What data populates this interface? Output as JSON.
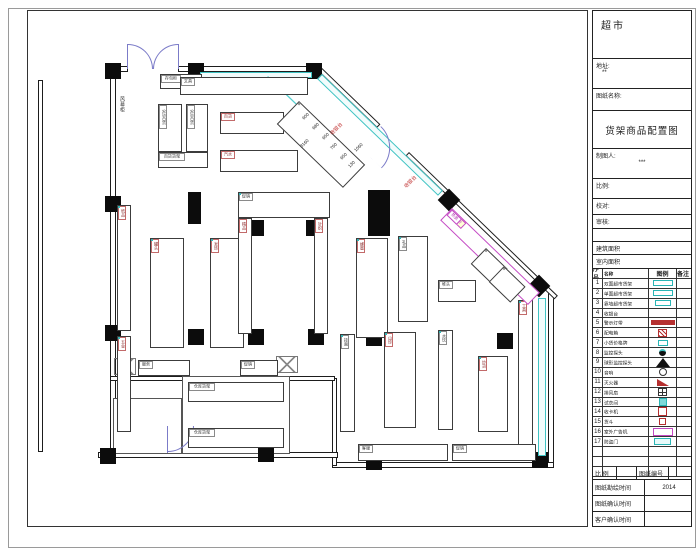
{
  "title_block": {
    "store_name": "超市",
    "address_label": "地址:",
    "address_value": "**",
    "drawing_name_label": "图纸名称:",
    "drawing_title": "货架商品配置图",
    "drafter_label": "制图人:",
    "drafter_value": "***",
    "scale_label": "比例:",
    "check_label": "校对:",
    "review_label": "审核:",
    "building_area_label": "建筑面积",
    "interior_area_label": "室内面积",
    "legend_header": {
      "no": "序号",
      "name": "名称",
      "symbol": "图例",
      "note": "备注"
    },
    "legend_rows": [
      {
        "no": "1",
        "name": "双面超市货架",
        "sym": "cyan-rect"
      },
      {
        "no": "2",
        "name": "单面超市货架",
        "sym": "cyan-rect"
      },
      {
        "no": "3",
        "name": "靠墙超市货架",
        "sym": "cyan-rect-sm"
      },
      {
        "no": "4",
        "name": "收银台",
        "sym": "m-text"
      },
      {
        "no": "5",
        "name": "警示灯带",
        "sym": "red-bar"
      },
      {
        "no": "6",
        "name": "配电箱",
        "sym": "red-hatch"
      },
      {
        "no": "7",
        "name": "小货价格牌",
        "sym": "cyan-sm"
      },
      {
        "no": "8",
        "name": "监控探头",
        "sym": "dot-arc"
      },
      {
        "no": "9",
        "name": "球形监控探头",
        "sym": "fan"
      },
      {
        "no": "10",
        "name": "音响",
        "sym": "circle"
      },
      {
        "no": "11",
        "name": "灭火器",
        "sym": "red-flag"
      },
      {
        "no": "12",
        "name": "排风扇",
        "sym": "grid-sq"
      },
      {
        "no": "13",
        "name": "试衣间",
        "sym": "cyan-fill"
      },
      {
        "no": "14",
        "name": "收卡机",
        "sym": "red-outline"
      },
      {
        "no": "15",
        "name": "货斗",
        "sym": "red-outline-sm"
      },
      {
        "no": "16",
        "name": "室外广告机",
        "sym": "magenta-rect"
      },
      {
        "no": "17",
        "name": "防盗门",
        "sym": "cyan-label"
      },
      {
        "no": "",
        "name": "",
        "sym": "none"
      },
      {
        "no": "",
        "name": "",
        "sym": "none"
      },
      {
        "no": "",
        "name": "",
        "sym": "none"
      }
    ],
    "bottom_rows": {
      "scale_label": "比 例",
      "scale_value": "",
      "number_label": "图纸编号",
      "number_value": "",
      "survey_label": "图纸勘绘时间",
      "survey_value": "2014",
      "confirm_label": "图纸确认时间",
      "confirm_value": "",
      "client_label": "客户确认时间",
      "client_value": ""
    }
  },
  "plan": {
    "walls": [
      [
        38,
        80,
        5,
        372
      ],
      [
        110,
        64,
        6,
        392
      ],
      [
        110,
        66,
        18,
        6
      ],
      [
        178,
        66,
        142,
        6
      ],
      [
        548,
        292,
        6,
        176
      ],
      [
        332,
        462,
        222,
        6
      ],
      [
        332,
        378,
        5,
        88
      ],
      [
        110,
        376,
        225,
        5
      ],
      [
        98,
        452,
        240,
        6
      ]
    ],
    "dwalls": [
      {
        "x": 320,
        "y": 66,
        "len": 84,
        "rot": 44
      },
      {
        "x": 409,
        "y": 152,
        "len": 207,
        "rot": 44
      }
    ],
    "outlines": [
      [
        182,
        376,
        108,
        78
      ],
      [
        113,
        398,
        69,
        56
      ]
    ],
    "columns": [
      [
        105,
        63
      ],
      [
        188,
        63
      ],
      [
        306,
        63
      ],
      [
        105,
        196
      ],
      [
        105,
        325
      ],
      [
        100,
        448
      ],
      [
        258,
        446
      ],
      [
        248,
        220
      ],
      [
        306,
        220
      ],
      [
        188,
        329
      ],
      [
        248,
        329
      ],
      [
        308,
        329
      ],
      [
        366,
        330
      ],
      [
        497,
        333
      ],
      [
        366,
        454
      ],
      [
        532,
        452
      ]
    ],
    "diamonds": [
      [
        441,
        192
      ],
      [
        531,
        278
      ]
    ],
    "bands": [
      [
        200,
        72,
        112,
        6
      ],
      [
        538,
        298,
        8,
        158
      ]
    ],
    "dbands": [
      {
        "x": 322,
        "y": 74,
        "len": 168,
        "rot": 44,
        "h": 7
      }
    ],
    "solids": [
      [
        188,
        192,
        13,
        32
      ],
      [
        368,
        190,
        22,
        46
      ]
    ],
    "xboxes": [
      [
        114,
        358,
        22,
        17
      ],
      [
        276,
        356,
        22,
        17
      ]
    ],
    "qlines": [
      {
        "x": 268,
        "y": 76,
        "len": 72
      },
      {
        "x": 278,
        "y": 86,
        "len": 72
      }
    ],
    "arcs": [
      {
        "x": 128,
        "y": 44,
        "s": 25,
        "t": "tr",
        "rot": 0
      },
      {
        "x": 153,
        "y": 44,
        "s": 25,
        "t": "tl",
        "rot": 0
      },
      {
        "x": 381,
        "y": 126,
        "s": 30,
        "t": "tr",
        "rot": 44
      },
      {
        "x": 168,
        "y": 426,
        "s": 26,
        "t": "br",
        "rot": 0
      }
    ],
    "leaves": [
      [
        127,
        44,
        1,
        25
      ],
      [
        178,
        44,
        1,
        25
      ],
      [
        167,
        426,
        1,
        27
      ]
    ],
    "gondolas": [
      {
        "x": 160,
        "y": 74,
        "w": 42,
        "h": 15,
        "dir": "h",
        "cols": 1,
        "style": "dark",
        "caps": 0,
        "labels": [
          "存包柜"
        ]
      },
      {
        "x": 180,
        "y": 77,
        "w": 128,
        "h": 18,
        "dir": "h",
        "cols": 1,
        "style": "dark",
        "caps": 0,
        "labels": [
          "日配",
          "休闲",
          "百货",
          "文具"
        ]
      },
      {
        "x": 158,
        "y": 104,
        "w": 24,
        "h": 48,
        "dir": "v",
        "cols": 1,
        "style": "dark",
        "caps": 0,
        "labels": [
          "915百货"
        ]
      },
      {
        "x": 186,
        "y": 104,
        "w": 22,
        "h": 48,
        "dir": "v",
        "cols": 1,
        "style": "dark",
        "caps": 0,
        "labels": [
          "910百货"
        ]
      },
      {
        "x": 158,
        "y": 152,
        "w": 50,
        "h": 16,
        "dir": "h",
        "cols": 1,
        "style": "dark",
        "caps": 0,
        "labels": [
          "百货货架"
        ]
      },
      {
        "x": 220,
        "y": 112,
        "w": 64,
        "h": 22,
        "dir": "h",
        "cols": 1,
        "style": "red",
        "caps": 0,
        "labels": [
          "饰品",
          "洗化",
          "百货"
        ]
      },
      {
        "x": 220,
        "y": 150,
        "w": 78,
        "h": 22,
        "dir": "h",
        "cols": 1,
        "style": "red",
        "caps": 0,
        "labels": [
          "文具",
          "玩具",
          "精品",
          "汽水"
        ]
      },
      {
        "x": 117,
        "y": 205,
        "w": 14,
        "h": 126,
        "dir": "v",
        "cols": 1,
        "style": "red",
        "caps": 1,
        "labels": [
          "酒水",
          "饮料",
          "乳品",
          "冲调",
          "粮油",
          "调味",
          "纸品"
        ]
      },
      {
        "x": 117,
        "y": 336,
        "w": 14,
        "h": 96,
        "dir": "v",
        "cols": 1,
        "style": "red",
        "caps": 1,
        "labels": [
          "清洁",
          "日杂",
          "家居",
          "文体",
          "五金"
        ]
      },
      {
        "x": 150,
        "y": 238,
        "w": 34,
        "h": 110,
        "dir": "v",
        "cols": 2,
        "style": "red",
        "caps": 1,
        "labels": [
          "粮油",
          "调味",
          "南北",
          "干货",
          "方便",
          "冲调",
          "饼干",
          "糖果",
          "蜜饯",
          "坚果",
          "炒货",
          "罐头"
        ]
      },
      {
        "x": 210,
        "y": 238,
        "w": 34,
        "h": 110,
        "dir": "v",
        "cols": 2,
        "style": "red",
        "caps": 1,
        "labels": [
          "洗发",
          "护肤",
          "牙膏",
          "香皂",
          "纸品",
          "洗涤",
          "日化",
          "清洁",
          "卫生",
          "湿巾",
          "棉品",
          "发饰"
        ]
      },
      {
        "x": 238,
        "y": 192,
        "w": 92,
        "h": 26,
        "dir": "h",
        "cols": 1,
        "style": "dark",
        "caps": 1,
        "labels": [
          "挂件",
          "饰品",
          "促销"
        ]
      },
      {
        "x": 238,
        "y": 218,
        "w": 14,
        "h": 116,
        "dir": "v",
        "cols": 1,
        "style": "red",
        "caps": 0,
        "labels": [
          "文具",
          "玩具",
          "图书",
          "期刊",
          "音像",
          "礼品",
          "精品"
        ]
      },
      {
        "x": 314,
        "y": 218,
        "w": 14,
        "h": 116,
        "dir": "v",
        "cols": 1,
        "style": "red",
        "caps": 0,
        "labels": [
          "内衣",
          "袜子",
          "毛巾",
          "床品",
          "拖鞋",
          "箱包",
          "针织"
        ]
      },
      {
        "x": 356,
        "y": 238,
        "w": 32,
        "h": 100,
        "dir": "v",
        "cols": 2,
        "style": "red",
        "caps": 1,
        "labels": [
          "酒水",
          "白酒",
          "红酒",
          "啤酒",
          "饮料",
          "果汁",
          "茶饮",
          "乳品",
          "奶粉",
          "麦片",
          "冲饮",
          "蜂蜜"
        ]
      },
      {
        "x": 398,
        "y": 236,
        "w": 30,
        "h": 86,
        "dir": "v",
        "cols": 2,
        "style": "dark",
        "caps": 1,
        "labels": [
          "精品",
          "名烟",
          "名酒",
          "茶叶",
          "滋补",
          "礼盒",
          "保健",
          "参茸",
          "燕窝",
          "礼品"
        ]
      },
      {
        "x": 340,
        "y": 334,
        "w": 15,
        "h": 98,
        "dir": "v",
        "cols": 1,
        "style": "dark",
        "caps": 1,
        "labels": [
          "米面",
          "粮油",
          "食油",
          "杂粮",
          "挂面"
        ]
      },
      {
        "x": 384,
        "y": 332,
        "w": 32,
        "h": 96,
        "dir": "v",
        "cols": 2,
        "style": "red",
        "caps": 1,
        "labels": [
          "调味",
          "酱油",
          "食醋",
          "味精",
          "香料",
          "腌制",
          "酱菜",
          "罐头",
          "南北",
          "干货",
          "海味",
          "山珍"
        ]
      },
      {
        "x": 438,
        "y": 330,
        "w": 15,
        "h": 100,
        "dir": "v",
        "cols": 1,
        "style": "dark",
        "caps": 1,
        "labels": [
          "方便",
          "速食",
          "罐头",
          "饮用",
          "水饮"
        ]
      },
      {
        "x": 478,
        "y": 356,
        "w": 30,
        "h": 76,
        "dir": "v",
        "cols": 2,
        "style": "red",
        "caps": 1,
        "labels": [
          "零食",
          "饼干",
          "糕点",
          "糖果",
          "巧克",
          "果冻",
          "膨化",
          "炒货"
        ]
      },
      {
        "x": 518,
        "y": 300,
        "w": 15,
        "h": 152,
        "dir": "v",
        "cols": 1,
        "style": "red",
        "caps": 1,
        "labels": [
          "家电",
          "小家",
          "电器",
          "插排",
          "灯具",
          "电池",
          "五金",
          "工具"
        ]
      },
      {
        "x": 358,
        "y": 444,
        "w": 90,
        "h": 17,
        "dir": "h",
        "cols": 1,
        "style": "dark",
        "caps": 0,
        "labels": [
          "收货",
          "打包",
          "客服"
        ]
      },
      {
        "x": 452,
        "y": 444,
        "w": 84,
        "h": 17,
        "dir": "h",
        "cols": 1,
        "style": "dark",
        "caps": 0,
        "labels": [
          "雨具",
          "季节",
          "促销"
        ]
      },
      {
        "x": 138,
        "y": 360,
        "w": 52,
        "h": 16,
        "dir": "h",
        "cols": 1,
        "style": "dark",
        "caps": 0,
        "labels": [
          "休息",
          "服务"
        ]
      },
      {
        "x": 240,
        "y": 360,
        "w": 38,
        "h": 16,
        "dir": "h",
        "cols": 1,
        "style": "dark",
        "caps": 0,
        "labels": [
          "促销"
        ]
      },
      {
        "x": 188,
        "y": 382,
        "w": 96,
        "h": 20,
        "dir": "h",
        "cols": 1,
        "style": "dark",
        "caps": 0,
        "labels": [
          "仓库货架",
          "仓库货架"
        ]
      },
      {
        "x": 188,
        "y": 428,
        "w": 96,
        "h": 20,
        "dir": "h",
        "cols": 1,
        "style": "dark",
        "caps": 0,
        "labels": [
          "仓库货架",
          "仓库货架"
        ]
      },
      {
        "x": 438,
        "y": 280,
        "w": 38,
        "h": 22,
        "dir": "h",
        "cols": 1,
        "style": "dark",
        "caps": 0,
        "labels": [
          "促销",
          "堆头"
        ]
      },
      {
        "x": 299,
        "y": 101,
        "w": 92,
        "h": 32,
        "dir": "h",
        "cols": 2,
        "style": "dark",
        "caps": 0,
        "rot": 44,
        "labels": [
          "",
          "",
          "",
          "",
          "",
          "",
          "",
          ""
        ]
      },
      {
        "x": 452,
        "y": 208,
        "w": 122,
        "h": 17,
        "dir": "h",
        "cols": 1,
        "style": "magenta",
        "caps": 0,
        "rot": 44,
        "labels": [
          "收银台",
          "特价",
          "促销",
          "新品",
          "热卖"
        ],
        "bgs": [
          "#ffffd6",
          "#ffffd6",
          "",
          "",
          ""
        ]
      },
      {
        "x": 486,
        "y": 248,
        "w": 30,
        "h": 22,
        "dir": "h",
        "cols": 1,
        "style": "dark",
        "caps": 0,
        "rot": 44,
        "labels": [
          ""
        ]
      },
      {
        "x": 504,
        "y": 266,
        "w": 30,
        "h": 22,
        "dir": "h",
        "cols": 1,
        "style": "dark",
        "caps": 0,
        "rot": 44,
        "labels": [
          ""
        ]
      }
    ],
    "dims": [
      {
        "t": "600",
        "x": 302,
        "y": 118
      },
      {
        "t": "680",
        "x": 312,
        "y": 128
      },
      {
        "t": "650",
        "x": 322,
        "y": 138
      },
      {
        "t": "3160",
        "x": 300,
        "y": 146
      },
      {
        "t": "760",
        "x": 330,
        "y": 148
      },
      {
        "t": "650",
        "x": 340,
        "y": 158
      },
      {
        "t": "130",
        "x": 348,
        "y": 166
      },
      {
        "t": "1060",
        "x": 354,
        "y": 150
      }
    ],
    "labels": [
      {
        "t": "风幕柜",
        "x": 119,
        "y": 96,
        "vert": 1,
        "size": 5,
        "color": "#333"
      },
      {
        "t": "收银台",
        "x": 330,
        "y": 133,
        "rot": -45,
        "size": 5,
        "color": "#c03030"
      },
      {
        "t": "收银台",
        "x": 404,
        "y": 186,
        "rot": -45,
        "size": 5,
        "color": "#c03030"
      }
    ]
  }
}
